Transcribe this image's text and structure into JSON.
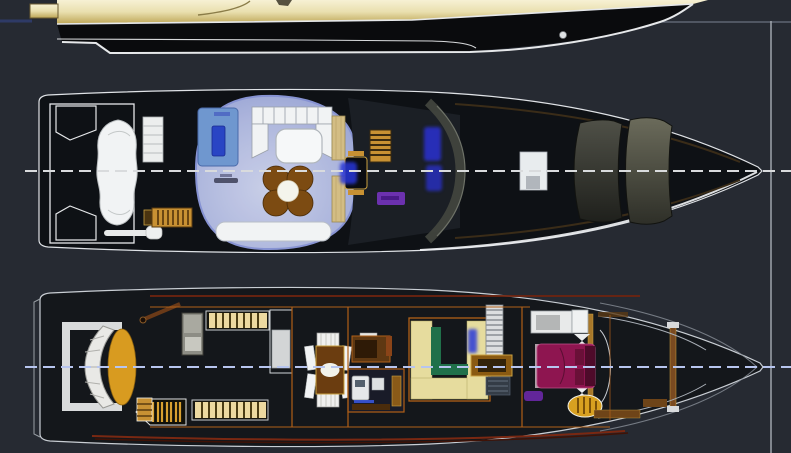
{
  "meta": {
    "description": "General-arrangement drawing of a motor yacht: partial side profile (top), upper deck / flybridge plan (middle), lower deck interior plan (bottom). Bow points right. No visible text labels in the drawing.",
    "canvas": {
      "width": 791,
      "height": 453
    }
  },
  "views": [
    {
      "id": "side-profile-view",
      "semantic": "yacht side profile, cream superstructure over black hull, swim platform at stern, porthole near bow"
    },
    {
      "id": "upper-deck-plan",
      "semantic": "plan view: stern davit frame, tender, boarding ladder, glass-roofed saloon with spa, settee, clover table, bench, helm with glowing displays, windshield panels, foredeck hatch"
    },
    {
      "id": "lower-deck-plan",
      "semantic": "plan view: amber stern seat, slatted benches, ladders, dining table, galley, cream corridor with green trim, staircase, magenta double bed, gold stool, bow cabin"
    }
  ],
  "reference_marks": {
    "horizontal_datum_y": 22,
    "vertical_datum_x": 771,
    "upper_centerline_y": 171,
    "lower_centerline_y": 367,
    "centerline_style": "dashed"
  },
  "colors": {
    "background": "#262a32",
    "hull_black": "#0a0b0d",
    "deck_dark": "#0e1115",
    "lower_hull_fill": "#14171b",
    "outline_white": "#e6e8ea",
    "profile_cream_light": "#f7f1d4",
    "profile_cream_dark": "#bda656",
    "glass_blue": "#b9c2ea",
    "spa_blue": "#6f97cf",
    "spa_inner_blue": "#2945c4",
    "furniture_white": "#f1f3f4",
    "table_brown": "#7c4b12",
    "tan_wood": "#d3bd84",
    "ladder_gold": "#c89133",
    "windshield_gray": "#4c4e46",
    "hatch_white": "#e8ecee",
    "centerline_upper": "#d9dbdd",
    "centerline_lower": "#b7c5ef",
    "maroon_trim": "#6e2410",
    "seat_amber": "#d89b20",
    "slat_cream": "#ecd9a0",
    "corridor_cream": "#e6dc9e",
    "corridor_green": "#20704a",
    "wall_orange": "#b06018",
    "bed_magenta": "#8e1550",
    "purple_accent": "#6a28a8",
    "glow_blue": "#2a33dc",
    "stair_white": "#dcdee0",
    "panel_gray": "#8d8d85",
    "reference_line": "#a8adb5",
    "reference_blue": "#2e3a66"
  }
}
